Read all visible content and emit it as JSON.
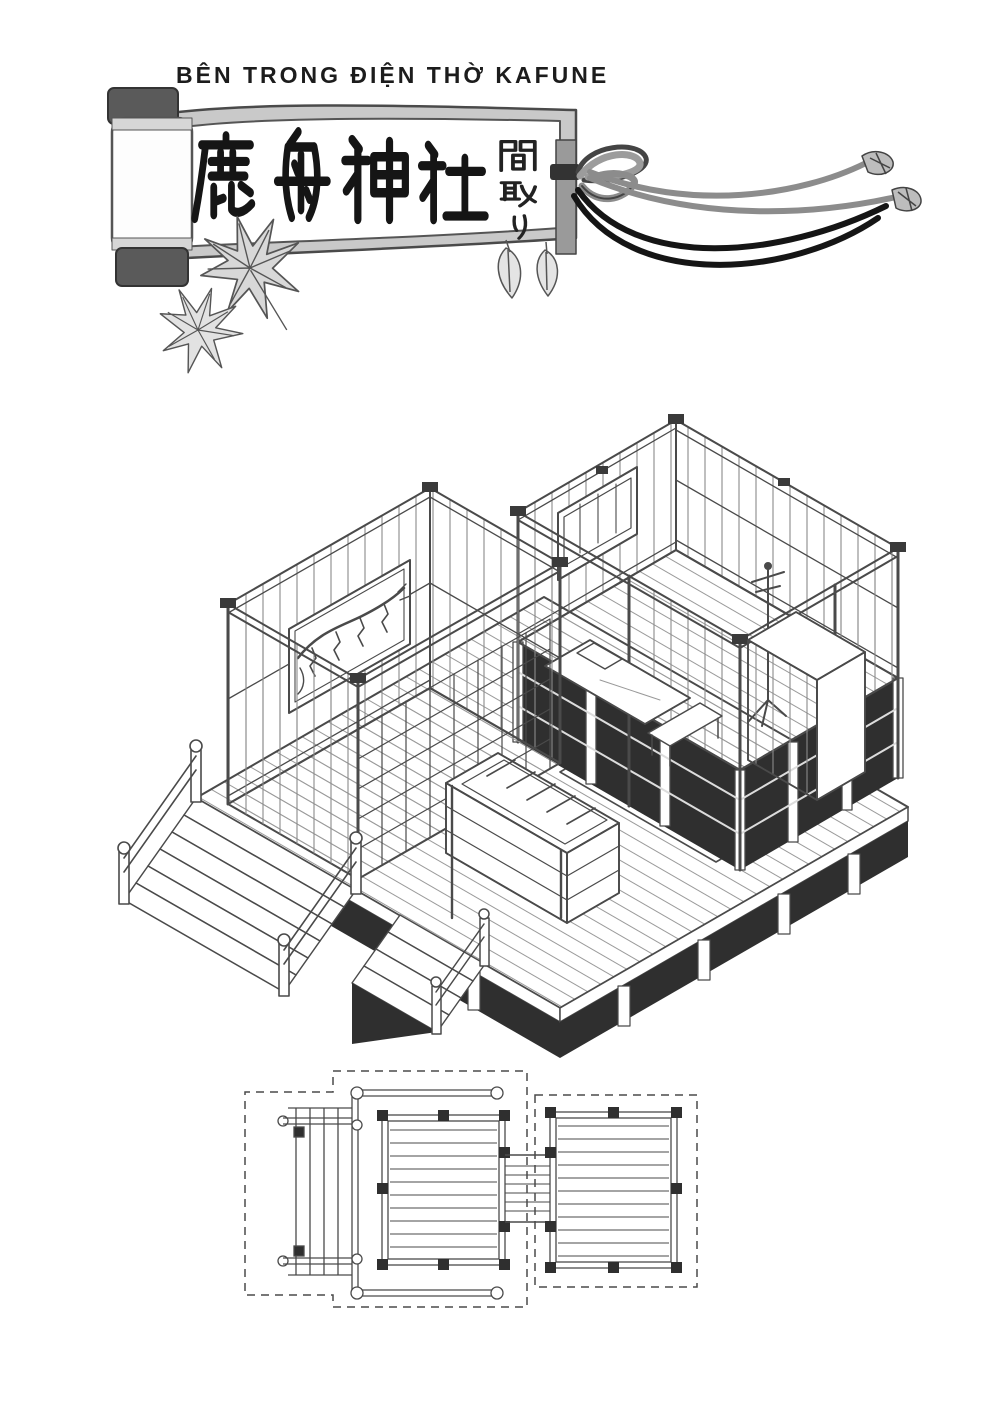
{
  "page": {
    "background": "#ffffff",
    "ink": "#2a2a2a",
    "shadow_fill": "#2f2f2f",
    "scroll_border_gray": "#c9c9c9"
  },
  "header": {
    "title": "BÊN TRONG ĐIỆN THỜ KAFUNE",
    "scroll": {
      "kanji_main": "鹿舟神社",
      "kanji_side_vertical": "間取り"
    },
    "decorations": [
      "scroll-roller",
      "scroll-rod",
      "hanging-cord",
      "cord-tassels",
      "maple-leaf",
      "maple-leaf",
      "hanging-leaves"
    ]
  },
  "figures": {
    "isometric_view": "shrine-isometric-cutaway-drawing",
    "floor_plan": "shrine-floor-plan-drawing"
  }
}
